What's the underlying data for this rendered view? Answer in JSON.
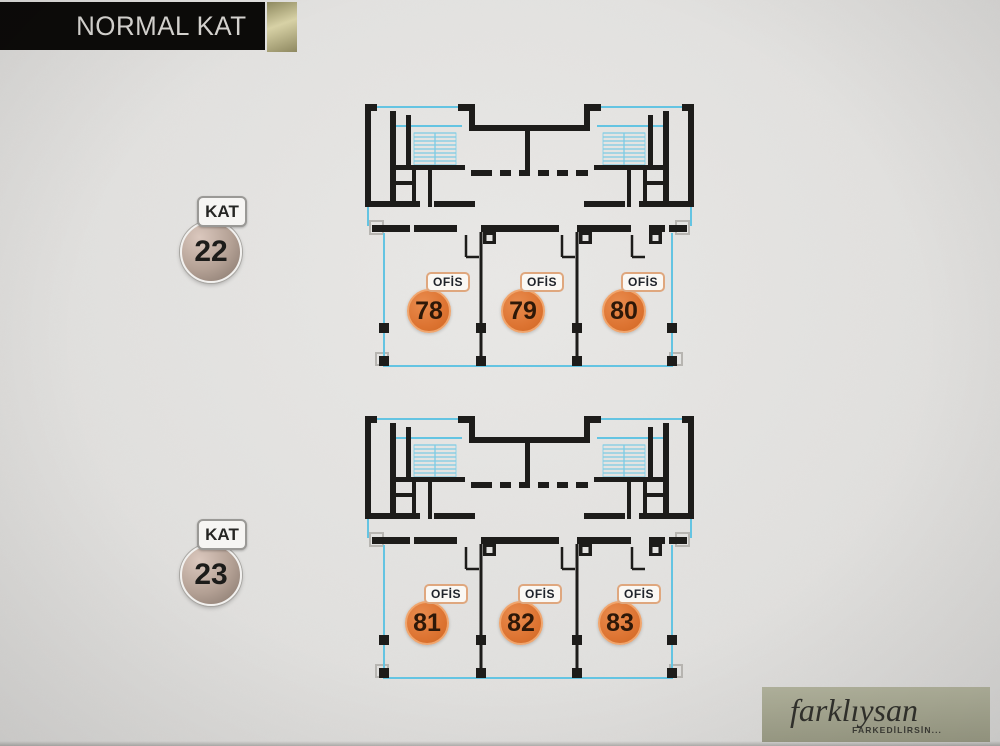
{
  "header": {
    "title": "NORMAL KAT"
  },
  "floors": [
    {
      "floor_label": "KAT",
      "floor_number": "22",
      "offices": [
        {
          "label": "OFİS",
          "number": "78"
        },
        {
          "label": "OFİS",
          "number": "79"
        },
        {
          "label": "OFİS",
          "number": "80"
        }
      ]
    },
    {
      "floor_label": "KAT",
      "floor_number": "23",
      "offices": [
        {
          "label": "OFİS",
          "number": "81"
        },
        {
          "label": "OFİS",
          "number": "82"
        },
        {
          "label": "OFİS",
          "number": "83"
        }
      ]
    }
  ],
  "logo": {
    "brand": "farklıysan",
    "tagline": "FARKEDİLİRSİN..."
  },
  "colors": {
    "accent_orange": "#dd7432",
    "plan_wall_black": "#1d1c1a",
    "plan_line_cyan": "#64c4e2",
    "badge_bronze": "#a8968a",
    "header_gold": "#b5ae82",
    "logo_sage": "#a5a690",
    "background_gray": "#e2e1df"
  }
}
